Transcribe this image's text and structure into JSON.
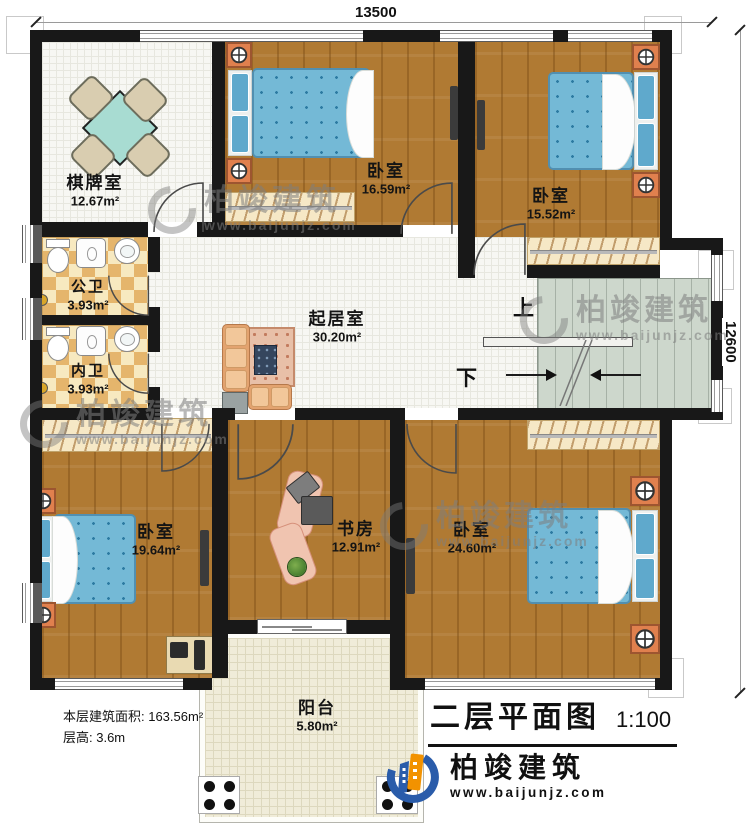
{
  "dimensions": {
    "top": "13500",
    "right": "12600"
  },
  "rooms": {
    "chess": {
      "name": "棋牌室",
      "area": "12.67m²"
    },
    "bed_top_mid": {
      "name": "卧室",
      "area": "16.59m²"
    },
    "bed_top_right": {
      "name": "卧室",
      "area": "15.52m²"
    },
    "bath_public": {
      "name": "公卫",
      "area": "3.93m²"
    },
    "bath_private": {
      "name": "内卫",
      "area": "3.93m²"
    },
    "living": {
      "name": "起居室",
      "area": "30.20m²"
    },
    "bed_bot_left": {
      "name": "卧室",
      "area": "19.64m²"
    },
    "study": {
      "name": "书房",
      "area": "12.91m²"
    },
    "bed_bot_right": {
      "name": "卧室",
      "area": "24.60m²"
    },
    "balcony": {
      "name": "阳台",
      "area": "5.80m²"
    }
  },
  "stairs": {
    "up": "上",
    "down": "下"
  },
  "info": {
    "floor_area": "本层建筑面积: 163.56m²",
    "floor_height": "层高: 3.6m"
  },
  "title": {
    "text": "二层平面图",
    "scale": "1:100"
  },
  "brand": {
    "name": "柏竣建筑",
    "site": "www.baijunjz.com"
  },
  "watermark": {
    "name": "柏竣建筑",
    "site": "www.baijunjz.com"
  },
  "colors": {
    "wall": "#181818",
    "wood": "#b07a33",
    "tile": "#e5b56c",
    "stair": "#cdd7cc",
    "mattress": "#74b9d6",
    "nightstand": "#e0804e",
    "logo_blue": "#2a5caa",
    "logo_orange": "#f29200"
  }
}
